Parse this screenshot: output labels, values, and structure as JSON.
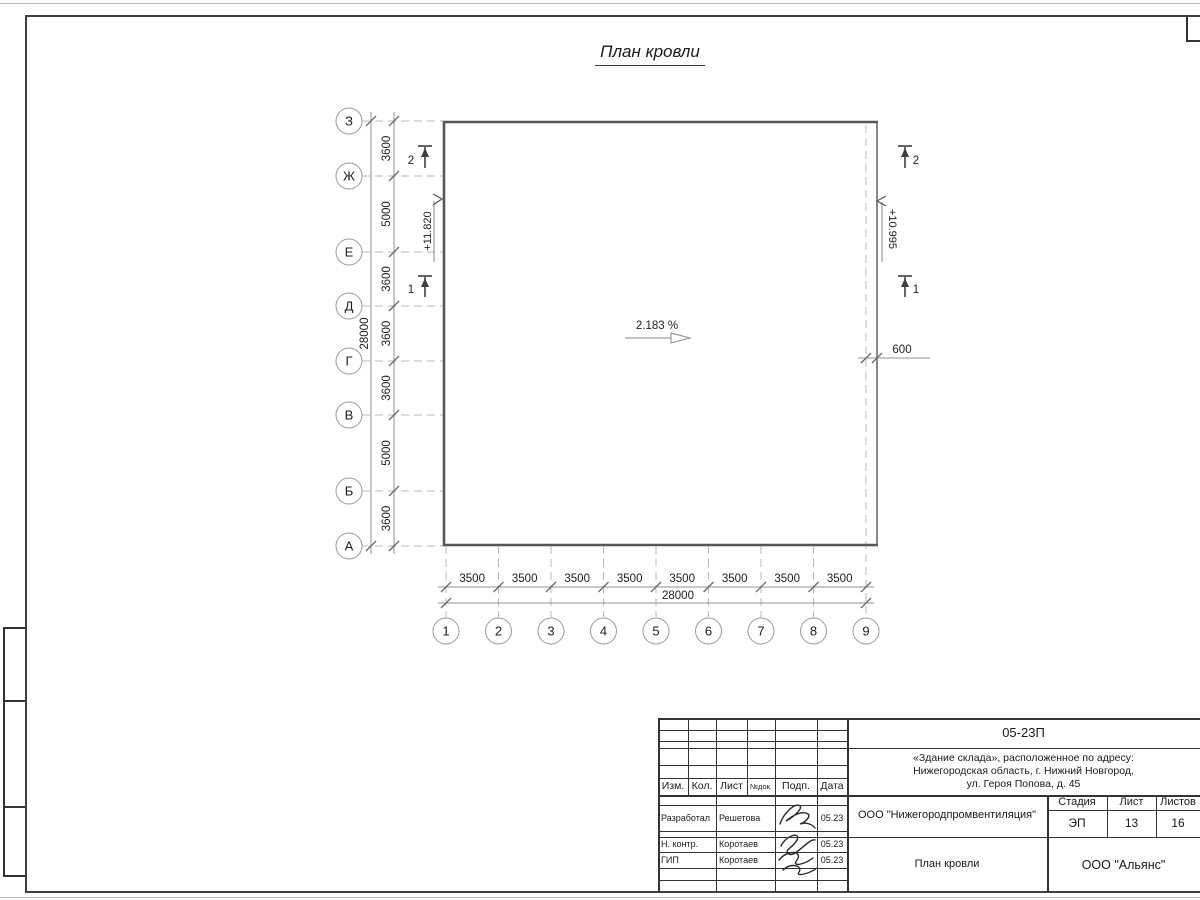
{
  "page": {
    "title": "План кровли"
  },
  "plan": {
    "row_axes": [
      "З",
      "Ж",
      "Е",
      "Д",
      "Г",
      "В",
      "Б",
      "А"
    ],
    "col_axes": [
      "1",
      "2",
      "3",
      "4",
      "5",
      "6",
      "7",
      "8",
      "9"
    ],
    "row_dims": [
      "3600",
      "5000",
      "3600",
      "3600",
      "3600",
      "5000",
      "3600"
    ],
    "row_total": "28000",
    "col_dims": [
      "3500",
      "3500",
      "3500",
      "3500",
      "3500",
      "3500",
      "3500",
      "3500"
    ],
    "col_total": "28000",
    "slope": "2.183 %",
    "elev_left": "+11.820",
    "elev_right": "+10.995",
    "edge_offset": "600",
    "section_top": "2",
    "section_bottom": "1"
  },
  "titleblock": {
    "doc_number": "05-23П",
    "project_line1": "«Здание склада», расположенное по адресу:",
    "project_line2": "Нижегородская область, г. Нижний Новгород,",
    "project_line3": "ул. Героя Попова, д. 45",
    "cols": {
      "izm": "Изм.",
      "kol": "Кол.",
      "list": "Лист",
      "ndoc": "№док.",
      "podp": "Подп.",
      "data": "Дата"
    },
    "rows": [
      {
        "role": "Разработал",
        "name": "Решетова",
        "date": "05.23"
      },
      {
        "role": "Н. контр.",
        "name": "Коротаев",
        "date": "05.23"
      },
      {
        "role": "ГИП",
        "name": "Коротаев",
        "date": "05.23"
      }
    ],
    "org": "ООО \"Нижегородпромвентиляция\"",
    "sheet_title": "План кровли",
    "stage_label": "Стадия",
    "sheet_label": "Лист",
    "sheets_label": "Листов",
    "stage": "ЭП",
    "sheet_num": "13",
    "sheets_total": "16",
    "company": "ООО \"Альянс\""
  },
  "colors": {
    "building_line": "#575757",
    "dim_line": "#909090",
    "dashed_line": "#b8b8b8",
    "frame_line": "#3f3f3f",
    "text": "#1e1e1e"
  }
}
